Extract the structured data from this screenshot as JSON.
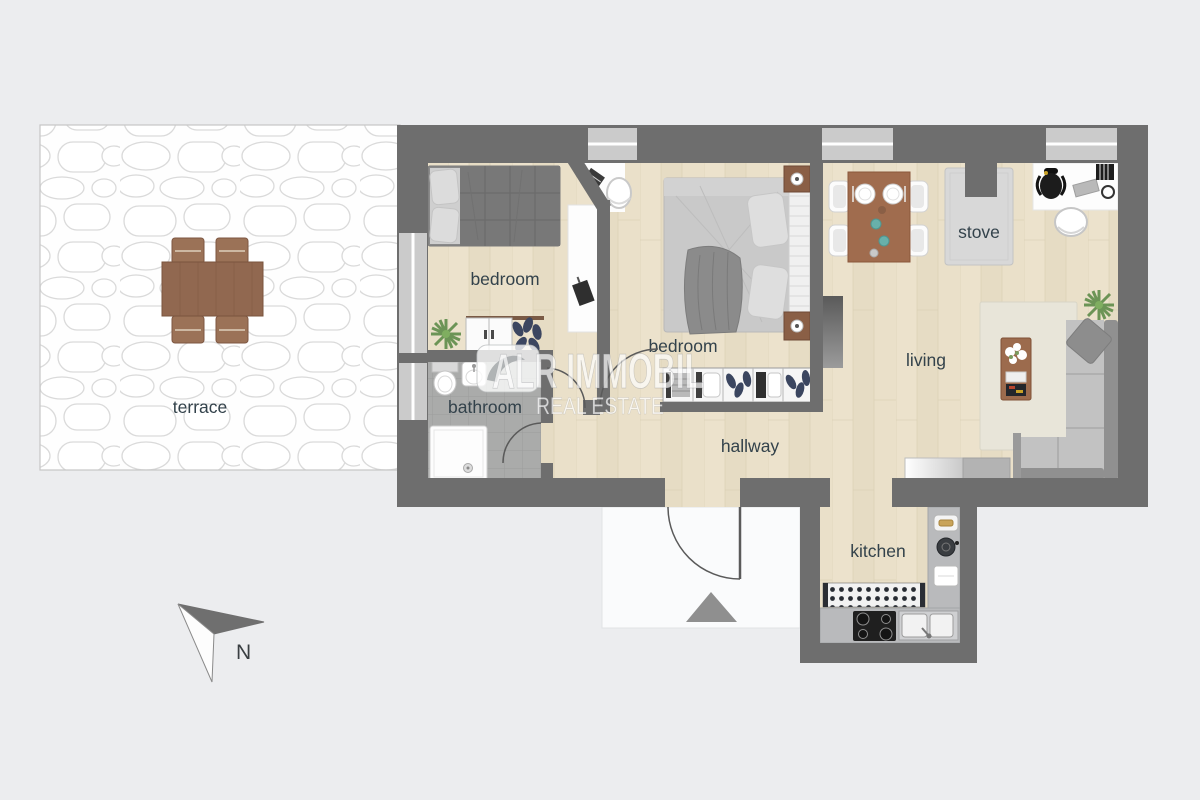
{
  "watermark": {
    "brand": "ALR IMMOBIL",
    "tagline": "REAL ESTATE"
  },
  "compass": {
    "north_label": "N"
  },
  "rooms": {
    "terrace": "terrace",
    "bedroom1": "bedroom",
    "bedroom2": "bedroom",
    "bathroom": "bathroom",
    "hallway": "hallway",
    "living": "living",
    "stove": "stove",
    "kitchen": "kitchen"
  },
  "colors": {
    "background": "#ecedef",
    "wall": "#6e6e6e",
    "wood_floor": "#e9dfc8",
    "bathroom_floor": "#aaabaa",
    "window_glass": "#cbcbcb",
    "label_text": "#33424b",
    "wood_furniture": "#9a6b4e",
    "sofa_gray": "#c2c2c2",
    "terrace_stone": "#ffffff"
  }
}
